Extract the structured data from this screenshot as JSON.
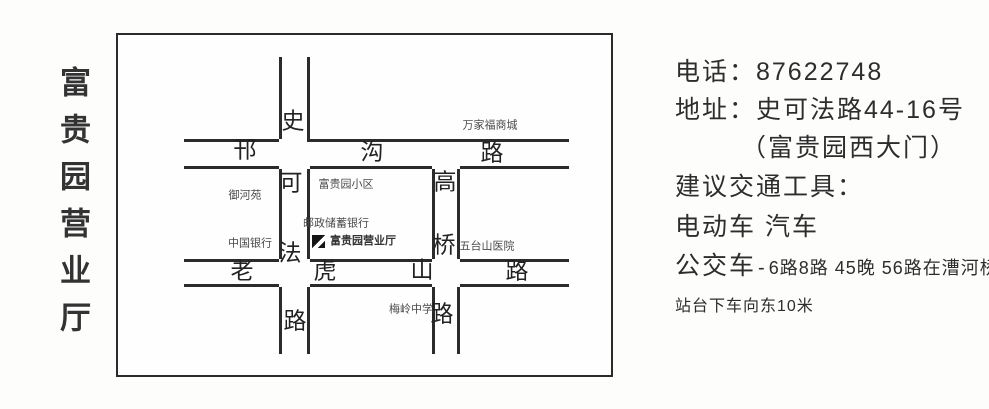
{
  "sidebar": {
    "title": "富贵园营业厅"
  },
  "map": {
    "streets": {
      "shikefa": {
        "name": "史可法路",
        "chars": [
          "史",
          "可",
          "法",
          "路"
        ]
      },
      "hangou": {
        "name": "邗沟路",
        "chars": [
          "邗",
          "沟",
          "路"
        ]
      },
      "gaoqiao": {
        "name": "高桥路",
        "chars": [
          "高",
          "桥",
          "路"
        ]
      },
      "laohushan": {
        "name": "老虎山路",
        "chars": [
          "老",
          "虎",
          "山",
          "路"
        ]
      }
    },
    "landmarks": {
      "wanjiafu_mall": "万家福商城",
      "yuheyuan": "御河苑",
      "bank_of_china": "中国银行",
      "fuguiyuan_community": "富贵园小区",
      "postal_savings_bank": "邮政储蓄银行",
      "fuguiyuan_hall": "富贵园营业厅",
      "wutaishan_hospital": "五台山医院",
      "meiling_school": "梅岭中学"
    }
  },
  "info": {
    "phone": "电话：87622748",
    "address": "地址：史可法路44-16号",
    "address_note": "（富贵园西大门）",
    "transport_title": "建议交通工具：",
    "vehicles": "电动车 汽车",
    "bus_label": "公交车",
    "bus_dash": "-",
    "bus_routes": "6路8路 45晚 56路在漕河桥",
    "bus_note": "站台下车向东10米"
  },
  "colors": {
    "road_line": "#2b2b2b",
    "text": "#2f2f2f"
  }
}
